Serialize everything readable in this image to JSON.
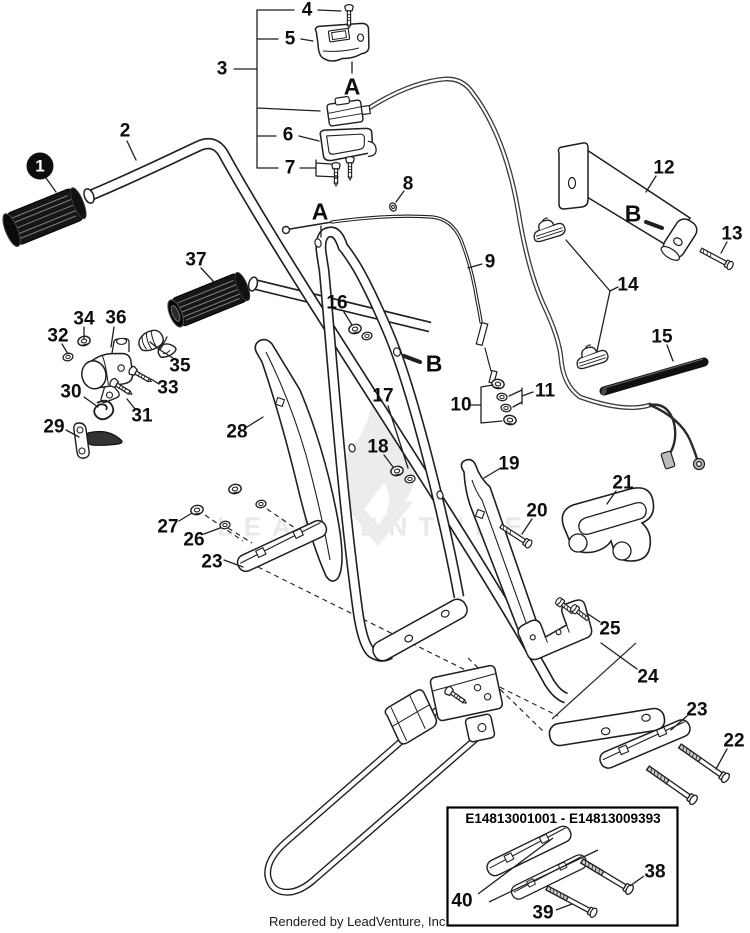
{
  "footer": {
    "text": "Rendered by LeadVenture, Inc."
  },
  "watermark": {
    "text": "LEADVENTURE"
  },
  "inset": {
    "title": "E14813001001 - E14813009393"
  },
  "letters": {
    "a": "A",
    "b": "B"
  },
  "callouts": {
    "n1": "1",
    "n2": "2",
    "n3": "3",
    "n4": "4",
    "n5": "5",
    "n6": "6",
    "n7": "7",
    "n8": "8",
    "n9": "9",
    "n10": "10",
    "n11": "11",
    "n12": "12",
    "n13": "13",
    "n14": "14",
    "n15": "15",
    "n16": "16",
    "n17": "17",
    "n18": "18",
    "n19": "19",
    "n20": "20",
    "n21": "21",
    "n22": "22",
    "n23": "23",
    "n24": "24",
    "n25": "25",
    "n26": "26",
    "n27": "27",
    "n28": "28",
    "n29": "29",
    "n30": "30",
    "n31": "31",
    "n32": "32",
    "n33": "33",
    "n34": "34",
    "n35": "35",
    "n36": "36",
    "n37": "37",
    "n38": "38",
    "n39": "39",
    "n40": "40"
  },
  "colors": {
    "line": "#1f1f1f",
    "accent_black": "#111111",
    "watermark_gray": "#e9e9e9",
    "background": "#ffffff"
  }
}
